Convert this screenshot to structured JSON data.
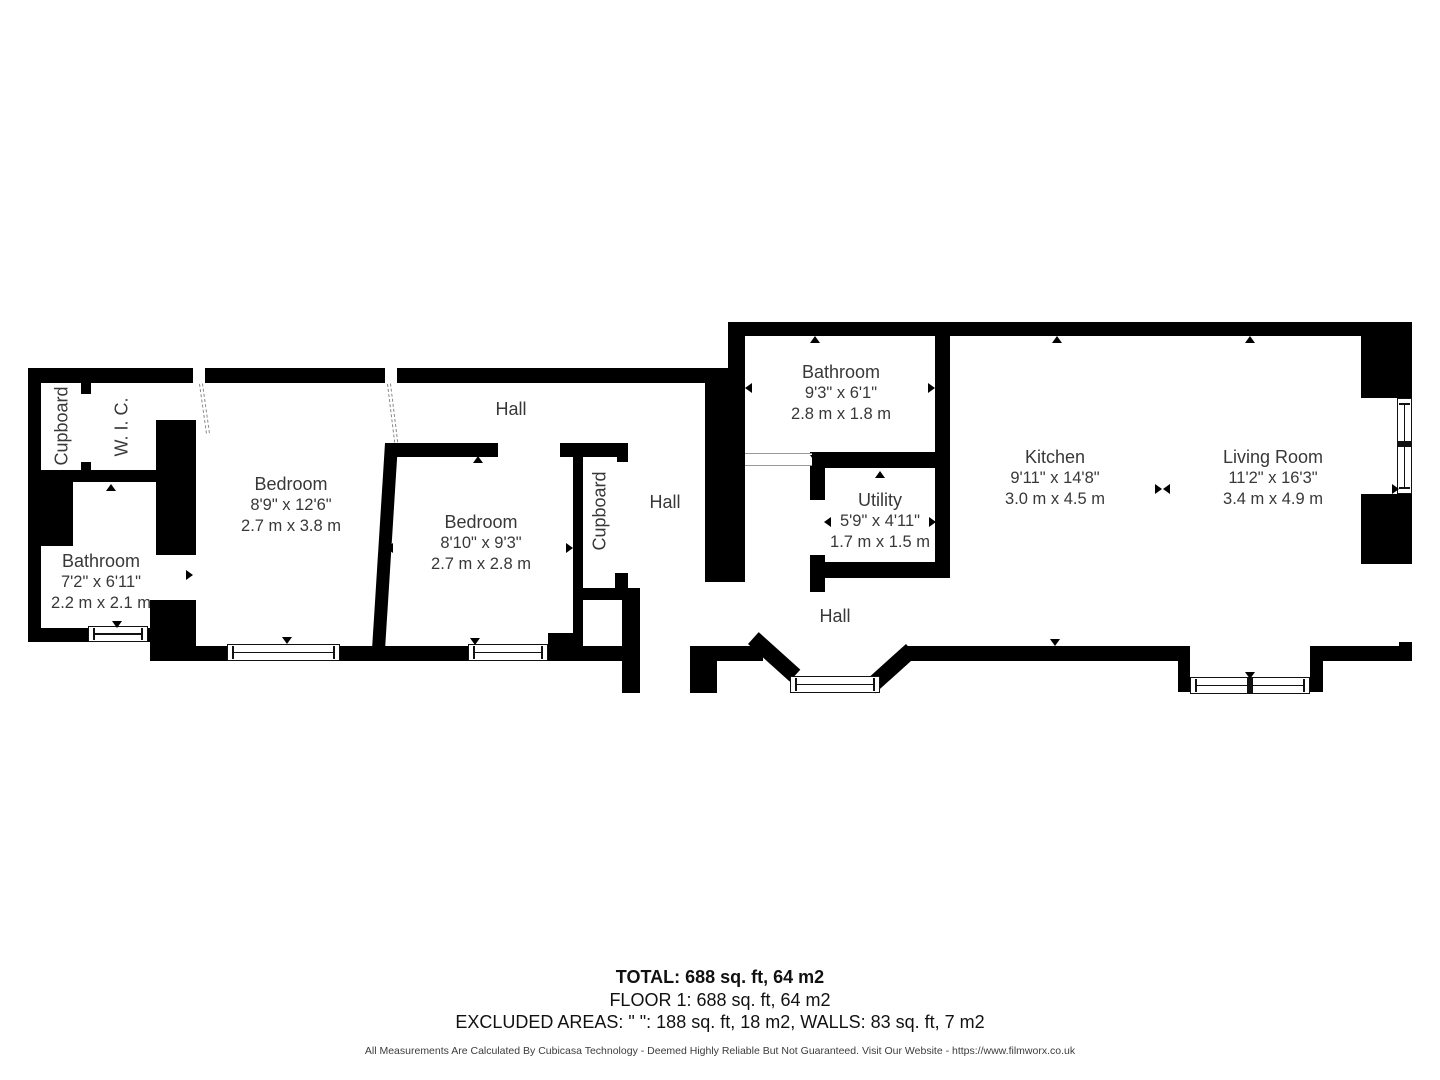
{
  "floorplan": {
    "cupboard_left": {
      "name": "Cupboard"
    },
    "wic": {
      "name": "W. I. C."
    },
    "bathroom_left": {
      "name": "Bathroom",
      "dim_ft": "7'2\" x 6'11\"",
      "dim_m": "2.2 m x 2.1 m"
    },
    "bedroom_1": {
      "name": "Bedroom",
      "dim_ft": "8'9\" x 12'6\"",
      "dim_m": "2.7 m x 3.8 m"
    },
    "hall_top": {
      "name": "Hall"
    },
    "bedroom_2": {
      "name": "Bedroom",
      "dim_ft": "8'10\" x 9'3\"",
      "dim_m": "2.7 m x 2.8 m"
    },
    "cupboard_2": {
      "name": "Cupboard"
    },
    "hall_mid": {
      "name": "Hall"
    },
    "bathroom_right": {
      "name": "Bathroom",
      "dim_ft": "9'3\" x 6'1\"",
      "dim_m": "2.8 m x 1.8 m"
    },
    "utility": {
      "name": "Utility",
      "dim_ft": "5'9\" x 4'11\"",
      "dim_m": "1.7 m x 1.5 m"
    },
    "hall_right": {
      "name": "Hall"
    },
    "kitchen": {
      "name": "Kitchen",
      "dim_ft": "9'11\" x 14'8\"",
      "dim_m": "3.0 m x 4.5 m"
    },
    "living_room": {
      "name": "Living Room",
      "dim_ft": "11'2\" x 16'3\"",
      "dim_m": "3.4 m x 4.9 m"
    }
  },
  "summary": {
    "total": "TOTAL: 688 sq. ft, 64 m2",
    "floor": "FLOOR 1: 688 sq. ft, 64 m2",
    "excluded": "EXCLUDED AREAS: \" \": 188 sq. ft, 18 m2, WALLS: 83 sq. ft, 7 m2"
  },
  "disclaimer": "All Measurements Are Calculated By Cubicasa Technology - Deemed Highly Reliable But Not Guaranteed. Visit Our Website - https://www.filmworx.co.uk",
  "colors": {
    "wall": "#000000",
    "background": "#ffffff",
    "room_text": "#383838"
  }
}
